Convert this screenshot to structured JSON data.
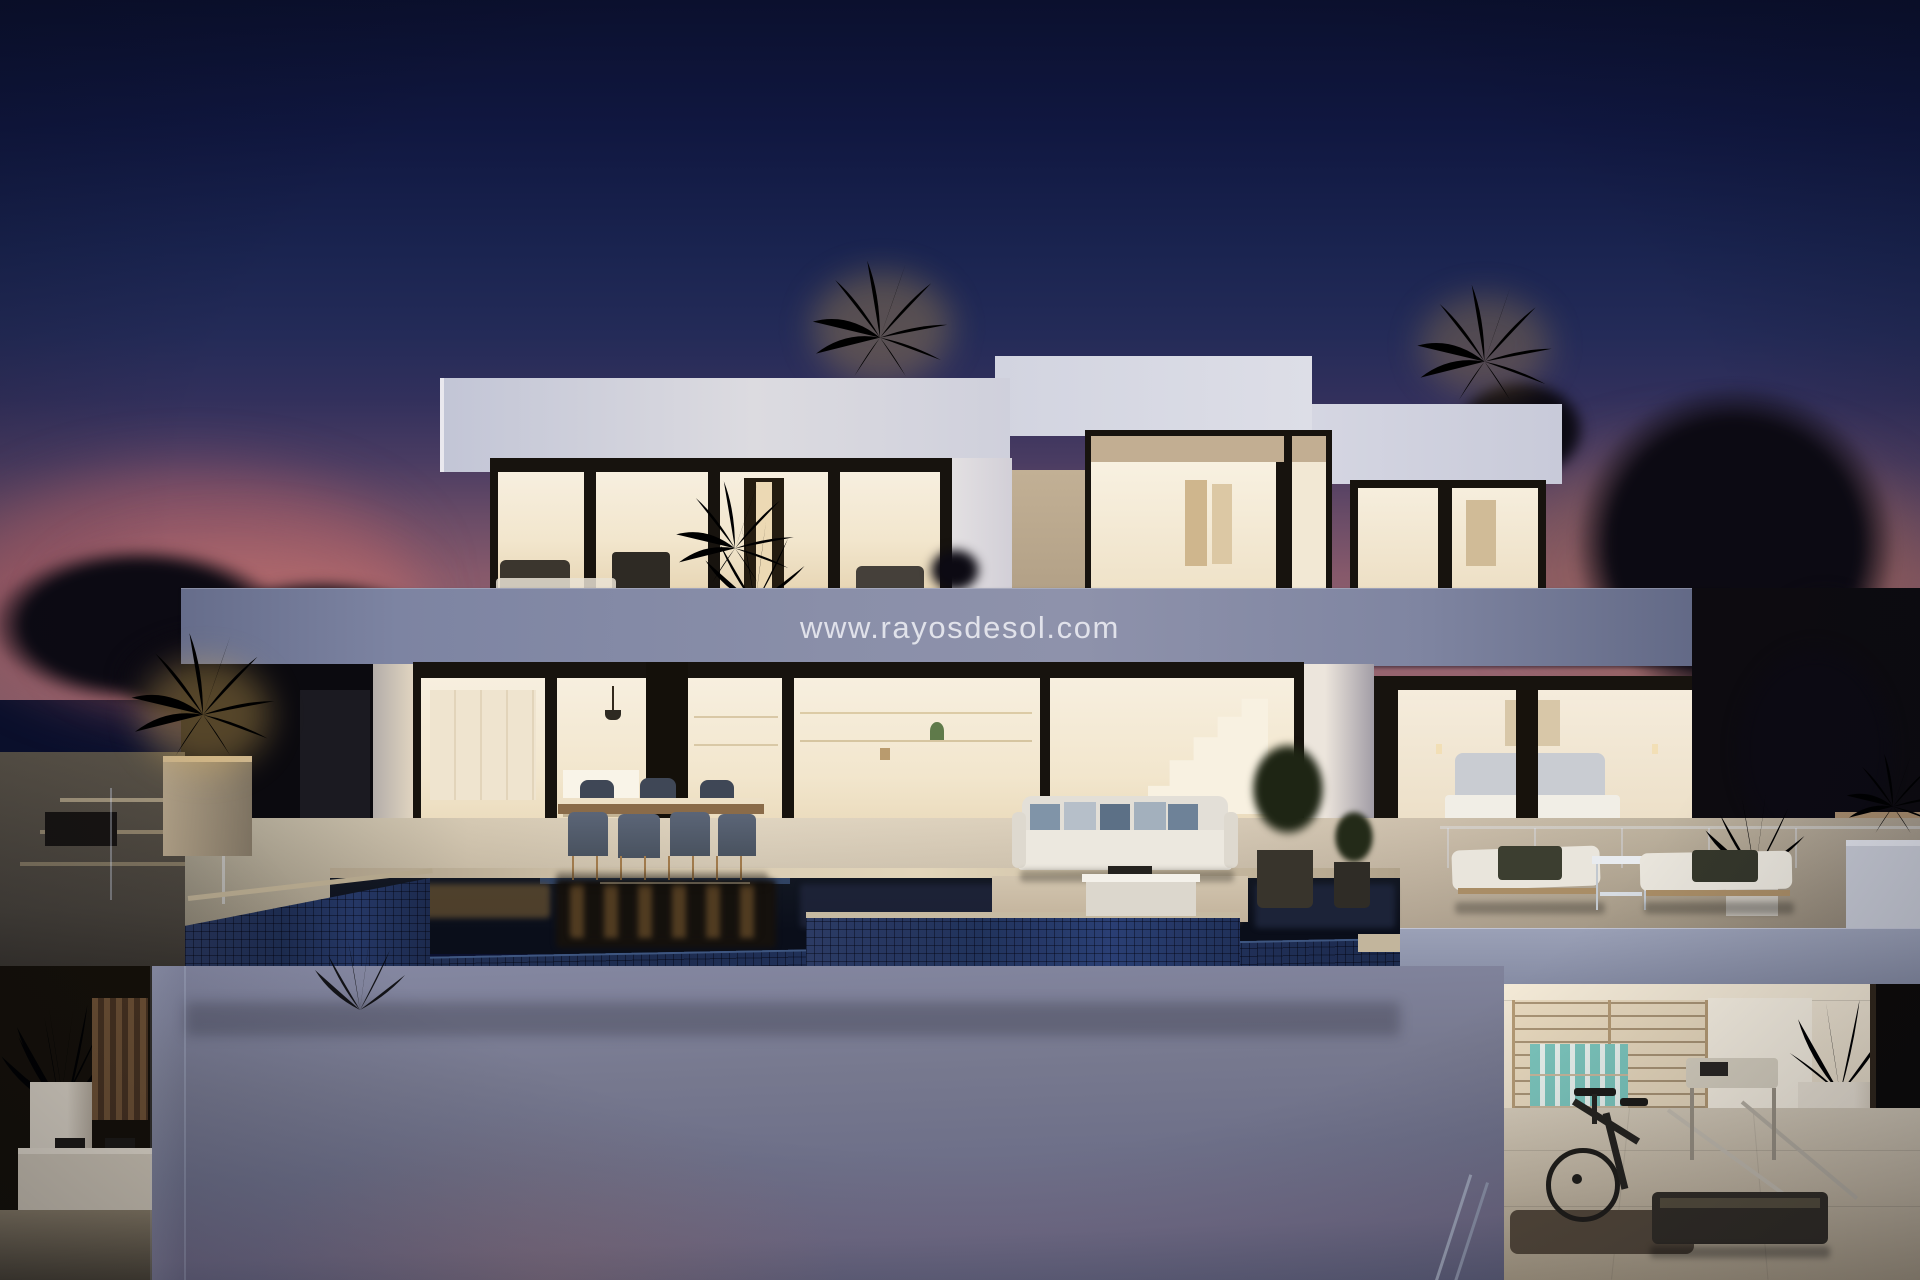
{
  "watermark": {
    "text": "www.rayosdesol.com"
  },
  "scene": {
    "type": "architectural-render-photo",
    "description": "Modern two-storey white villa at dusk with warm lit interiors, infinity pool, outdoor dining and lounge terraces, uplit palm trees and a basement gym",
    "time_of_day": "dusk",
    "areas": [
      "sky",
      "upper-floor-windows",
      "upper-balcony",
      "kitchen",
      "dining-terrace",
      "living-room",
      "staircase",
      "bedroom",
      "outdoor-sofa",
      "sun-loungers",
      "infinity-pool",
      "spa-ledge",
      "lower-wall",
      "garden-alcove",
      "gym"
    ]
  },
  "palette": {
    "sky_top": "#0b102e",
    "sky_mid": "#1a2450",
    "sky_dusk": "#4a3c62",
    "glow_pink": "#b05e66",
    "glow_warm": "#96604e",
    "tree_dark": "#0c0a13",
    "palm_lit": "#d2a452",
    "palm_green": "#7c9a47",
    "wall_white_lit": "#efeae1",
    "wall_white_dusk": "#c3c6d6",
    "fascia_dusk": "#8a8fa9",
    "frame_dark": "#17130e",
    "interior_warm": "#f7efdf",
    "interior_deep": "#e6d4b2",
    "terrace_stone": "#d5c8b2",
    "pool_water": "#0a0e1a",
    "pool_tile": "#1d2c50",
    "lower_wall": "#6e7089",
    "gym_wall": "#f0e6d4",
    "gym_floor": "#c4b8a4",
    "teal_accent": "#7cc6bd"
  }
}
